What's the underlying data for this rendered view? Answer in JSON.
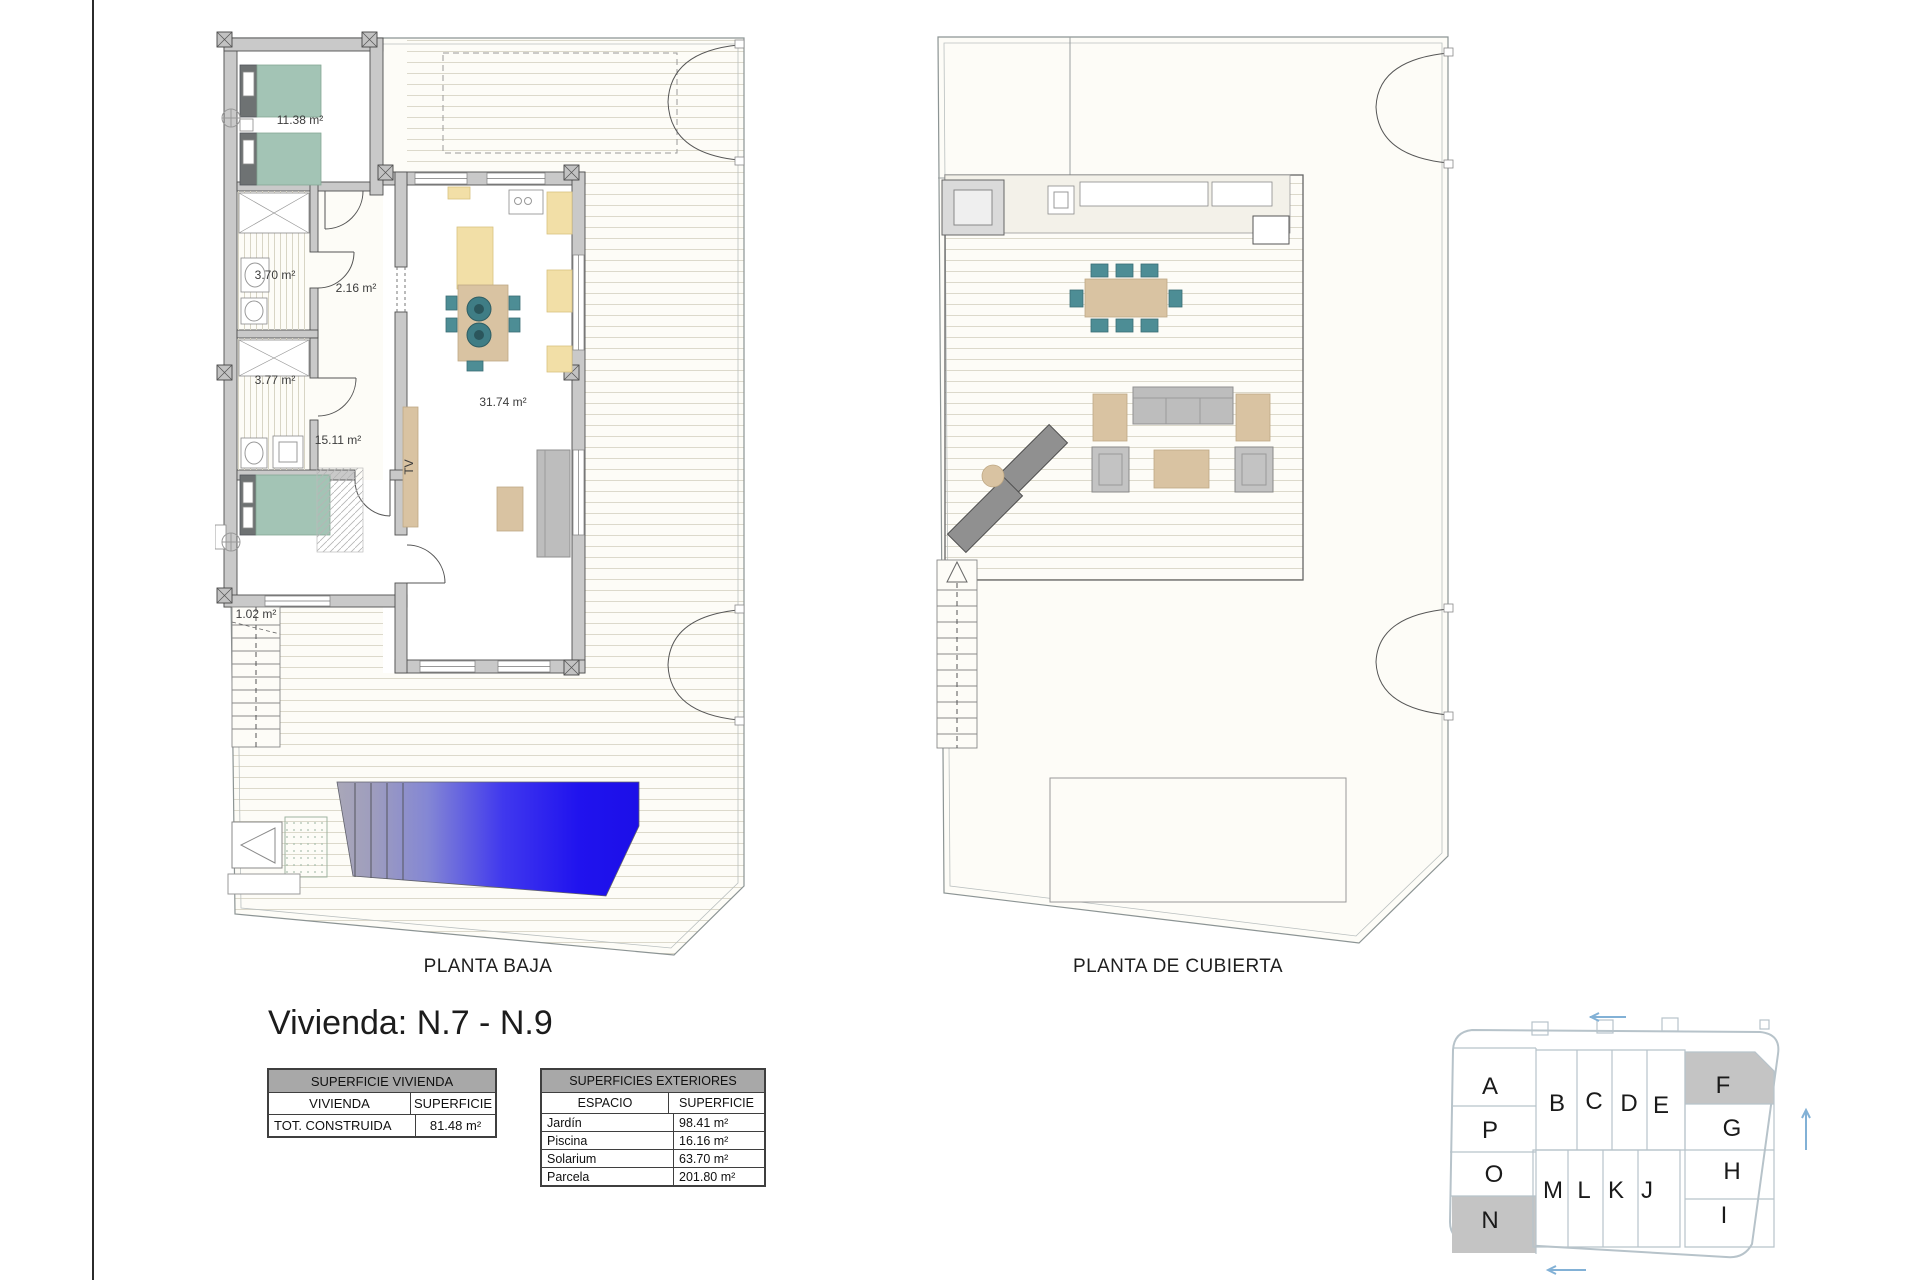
{
  "title": "Vivienda: N.7 - N.9",
  "plans": {
    "planta_baja": {
      "caption": "PLANTA BAJA",
      "labels": {
        "bedroom1": "11.38 m²",
        "bath1": "3.70 m²",
        "hall": "2.16 m²",
        "bath2": "3.77 m²",
        "bedroom2": "15.11 m²",
        "living": "31.74 m²",
        "stairs": "1.02 m²",
        "tv": "TV"
      }
    },
    "planta_cubierta": {
      "caption": "PLANTA DE CUBIERTA"
    }
  },
  "tables": {
    "vivienda": {
      "title": "SUPERFICIE VIVIENDA",
      "columns": [
        "VIVIENDA",
        "SUPERFICIE"
      ],
      "rows": [
        {
          "label": "TOT. CONSTRUIDA",
          "value": "81.48 m²"
        }
      ]
    },
    "exteriores": {
      "title": "SUPERFICIES EXTERIORES",
      "columns": [
        "ESPACIO",
        "SUPERFICIE"
      ],
      "rows": [
        {
          "label": "Jardín",
          "value": "98.41 m²"
        },
        {
          "label": "Piscina",
          "value": "16.16 m²"
        },
        {
          "label": "Solarium",
          "value": "63.70 m²"
        },
        {
          "label": "Parcela",
          "value": "201.80 m²"
        }
      ]
    }
  },
  "site_plan": {
    "lots": [
      "A",
      "P",
      "O",
      "N",
      "B",
      "C",
      "D",
      "E",
      "F",
      "G",
      "H",
      "I",
      "M",
      "L",
      "K",
      "J"
    ],
    "highlighted_lots": [
      "F",
      "N"
    ]
  },
  "colors": {
    "pool_blue": "#2013ee",
    "pool_steel": "#a9a7b8",
    "teal_furniture": "#4d8d95",
    "sage_bed": "#a3c4b5",
    "tan_wood": "#d9c3a2",
    "kitchen_yellow": "#f2dfa7",
    "wall_gray": "#c9c9c9",
    "table_header_gray": "#a8a8a8",
    "table_subheader_gray": "#d6d6d6",
    "site_outline_blue": "#b7c3ca",
    "site_arrow_blue": "#82b1d6",
    "site_highlight_gray": "#c4c4c4"
  }
}
